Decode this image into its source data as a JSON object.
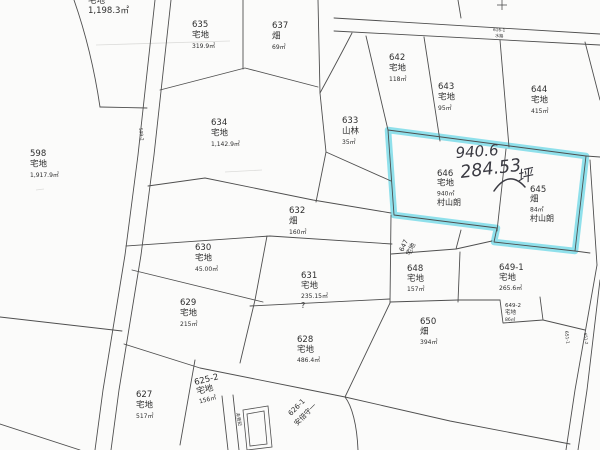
{
  "map": {
    "colors": {
      "highlight": "#86dde9",
      "ink": "#2e2e2e",
      "line": "#4f4f4f",
      "handwriting": "#3a3a42",
      "background": "#fbfbfa"
    },
    "handwriting": {
      "area_m2": "940.6",
      "area_tsubo": "284.53",
      "unit": "坪"
    },
    "highlighted_parcel_ids": [
      "646",
      "645"
    ],
    "parcels": [
      {
        "id": "topleft",
        "x": 88,
        "y": 3,
        "lh": 10,
        "lines": [
          "宅地",
          "1,198.3㎡"
        ]
      },
      {
        "id": "598",
        "x": 30,
        "y": 156,
        "lines": [
          "598",
          "宅地",
          "1,917.9㎡"
        ]
      },
      {
        "id": "635",
        "x": 192,
        "y": 27,
        "lines": [
          "635",
          "宅地",
          "319.9㎡"
        ]
      },
      {
        "id": "637",
        "x": 272,
        "y": 28,
        "lines": [
          "637",
          "畑",
          "69㎡"
        ]
      },
      {
        "id": "642",
        "x": 389,
        "y": 60,
        "lines": [
          "642",
          "宅地",
          "118㎡"
        ]
      },
      {
        "id": "643",
        "x": 438,
        "y": 89,
        "lines": [
          "643",
          "宅地",
          "95㎡"
        ]
      },
      {
        "id": "644",
        "x": 531,
        "y": 92,
        "lines": [
          "644",
          "宅地",
          "415㎡"
        ]
      },
      {
        "id": "634",
        "x": 211,
        "y": 125,
        "lines": [
          "634",
          "宅地",
          "1,142.9㎡"
        ]
      },
      {
        "id": "633",
        "x": 342,
        "y": 123,
        "lines": [
          "633",
          "山林",
          "35㎡"
        ]
      },
      {
        "id": "632",
        "x": 289,
        "y": 213,
        "lines": [
          "632",
          "畑",
          "160㎡"
        ]
      },
      {
        "id": "646",
        "x": 437,
        "y": 176,
        "lh": 9.7,
        "lines": [
          "646",
          "宅地",
          "940㎡",
          "村山朗"
        ]
      },
      {
        "id": "645",
        "x": 530,
        "y": 192,
        "lh": 9.7,
        "lines": [
          "645",
          "畑",
          "84㎡",
          "村山朗"
        ]
      },
      {
        "id": "630",
        "x": 195,
        "y": 250,
        "lines": [
          "630",
          "宅地",
          "45.00㎡"
        ]
      },
      {
        "id": "631",
        "x": 301,
        "y": 278,
        "lh": 10,
        "lines": [
          "631",
          "宅地",
          "235.15㎡",
          "?"
        ]
      },
      {
        "id": "629",
        "x": 180,
        "y": 305,
        "lines": [
          "629",
          "宅地",
          "215㎡"
        ]
      },
      {
        "id": "628",
        "x": 297,
        "y": 342,
        "lh": 10,
        "lines": [
          "628",
          "宅地",
          "486.4㎡"
        ]
      },
      {
        "id": "627",
        "x": 136,
        "y": 397,
        "lines": [
          "627",
          "宅地",
          "517㎡"
        ]
      },
      {
        "id": "625-2",
        "x": 195,
        "y": 385,
        "rot": -14,
        "lh": 9.5,
        "lines": [
          "625-2",
          "宅地",
          "156㎡"
        ]
      },
      {
        "id": "648",
        "x": 407,
        "y": 271,
        "lh": 10,
        "lines": [
          "648",
          "宅地",
          "157㎡"
        ]
      },
      {
        "id": "649-1",
        "x": 499,
        "y": 270,
        "lh": 10,
        "lines": [
          "649-1",
          "宅地",
          "265.6㎡"
        ]
      },
      {
        "id": "649-2",
        "x": 505,
        "y": 307,
        "lh": 7,
        "ls": [
          5.5,
          5.5,
          4.5
        ],
        "lines": [
          "649-2",
          "宅地",
          "86㎡"
        ]
      },
      {
        "id": "650",
        "x": 420,
        "y": 324,
        "lh": 10,
        "lines": [
          "650",
          "畑",
          "394㎡"
        ]
      }
    ],
    "small_labels": [
      {
        "name": "parcel-647-number",
        "text": "647",
        "x": 403,
        "y": 252,
        "rot": -65,
        "size": 6.5
      },
      {
        "name": "parcel-647-type",
        "text": "宅地",
        "x": 410,
        "y": 256,
        "rot": -65,
        "size": 6.5
      },
      {
        "name": "diagonal-label-line1",
        "text": "626-1",
        "x": 291,
        "y": 416,
        "rot": -45,
        "size": 7
      },
      {
        "name": "diagonal-label-line2",
        "text": "安倍守一",
        "x": 297,
        "y": 426,
        "rot": -45,
        "size": 7
      },
      {
        "name": "road-label-left",
        "text": "599-2",
        "x": 139,
        "y": 128,
        "rot": 82,
        "size": 4.5
      },
      {
        "name": "strip-label-1",
        "text": "616-1",
        "x": 493,
        "y": 31,
        "rot": 3,
        "size": 4.2
      },
      {
        "name": "strip-label-2",
        "text": "水路",
        "x": 495,
        "y": 37,
        "rot": 3,
        "size": 4.2
      },
      {
        "name": "road-label-right-1",
        "text": "651-1",
        "x": 565,
        "y": 331,
        "rot": 84,
        "size": 4.5
      },
      {
        "name": "road-label-right-2",
        "text": "651-2",
        "x": 584,
        "y": 333,
        "rot": 84,
        "size": 4
      },
      {
        "name": "building-label",
        "text": "未登記",
        "x": 236,
        "y": 413,
        "rot": 78,
        "size": 4.5
      }
    ]
  }
}
